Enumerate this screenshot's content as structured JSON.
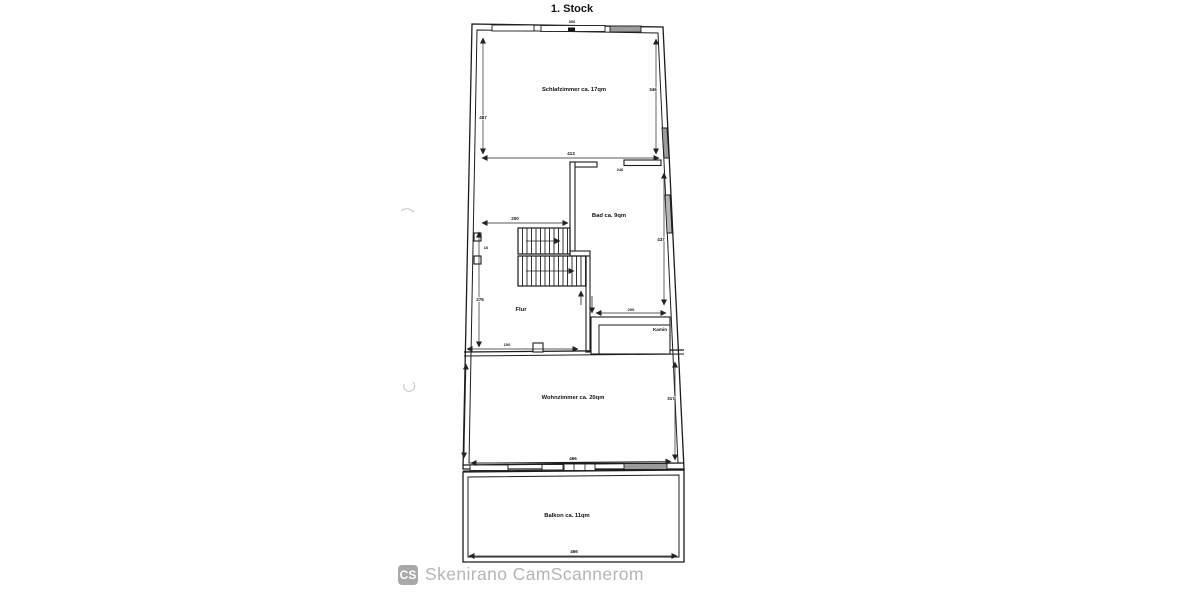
{
  "plan": {
    "title": "1. Stock"
  },
  "rooms": {
    "schlafzimmer": "Schlafzimmer ca. 17qm",
    "bad": "Bad ca. 9qm",
    "flur": "Flur",
    "kamin": "Kamin",
    "wohnzimmer": "Wohnzimmer ca. 20qm",
    "balkon": "Balkon ca. 11qm"
  },
  "dimensions": {
    "schlafzimmer_width": "413",
    "schlafzimmer_height_left": "487",
    "schlafzimmer_height_right": "346",
    "top_wall_mark": "306",
    "stair_hall_width": "200",
    "wall_niche": "16",
    "flur_height": "276",
    "flur_door": "100",
    "bad_door": "246",
    "bad_height": "437",
    "kamin_width": "200",
    "wohnzimmer_height": "317",
    "wohnzimmer_width": "466",
    "balkon_width": "466"
  },
  "watermark": {
    "logo": "CS",
    "text": "Skenirano CamScannerom"
  },
  "colors": {
    "line": "#1c1c1c",
    "window_shade": "#9b9b9b",
    "watermark_text": "#b5b5b5",
    "watermark_badge": "#a9a9a9"
  }
}
